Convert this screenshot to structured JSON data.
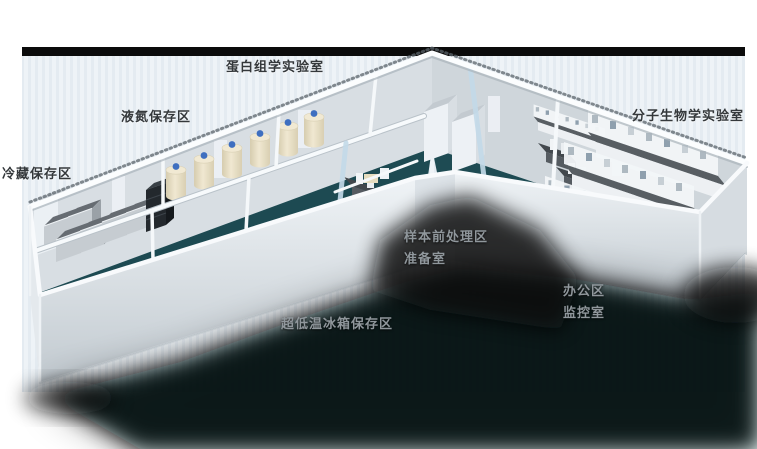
{
  "scene": {
    "kind": "3d-laboratory-floorplan-render",
    "colors": {
      "page_background": "#ffffff",
      "top_bar": "#0b0b0b",
      "backdrop_stripe_a": "#eef3f7",
      "backdrop_stripe_b": "#e4ebf1",
      "floor": "#1d4a52",
      "walls": "#f5f8fa",
      "shadow": "#000000",
      "tank_body": "#ece3cb",
      "tank_cap": "#3f6fc0",
      "label_dark": "#34383b",
      "label_light": "#90979c"
    }
  },
  "areas": [
    {
      "name": "proteomics-lab",
      "label": "蛋白组学实验室",
      "style": "dark"
    },
    {
      "name": "liquid-nitrogen-storage",
      "label": "液氮保存区",
      "style": "dark"
    },
    {
      "name": "cold-storage",
      "label": "冷藏保存区",
      "style": "dark"
    },
    {
      "name": "molecular-biology-lab",
      "label": "分子生物学实验室",
      "style": "dark"
    },
    {
      "name": "sample-pretreatment",
      "label": "样本前处理区",
      "style": "light"
    },
    {
      "name": "preparation-room",
      "label": "准备室",
      "style": "light"
    },
    {
      "name": "office-area",
      "label": "办公区",
      "style": "light"
    },
    {
      "name": "monitoring-room",
      "label": "监控室",
      "style": "light"
    },
    {
      "name": "ult-freezer-storage",
      "label": "超低温冰箱保存区",
      "style": "light"
    }
  ]
}
